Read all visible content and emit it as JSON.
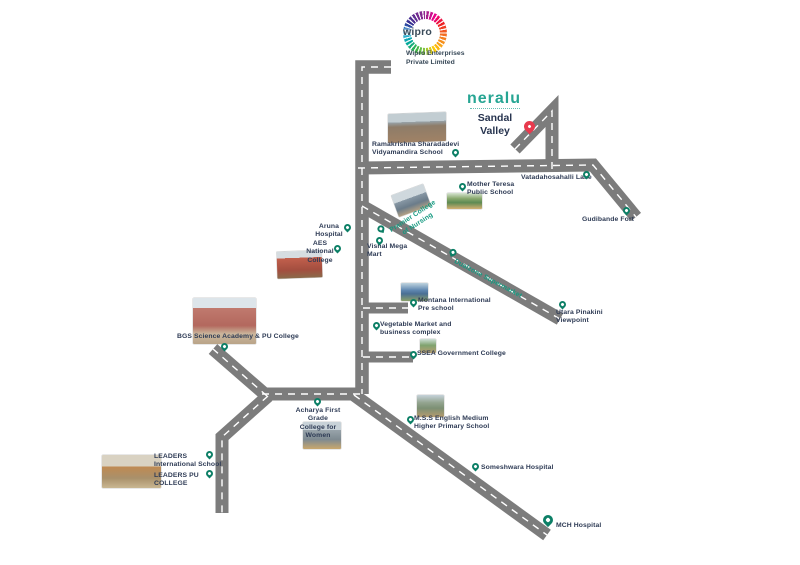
{
  "map": {
    "brands": {
      "wipro": {
        "logo_text": "wipro",
        "company": "Wipro Enterprises\nPrivate Limited"
      },
      "neralu": {
        "logo_text": "neralu",
        "project": "Sandal\nValley"
      }
    },
    "colors": {
      "road": "#7c7c7c",
      "road_dash": "#ffffff",
      "pin": "#0c7f66",
      "text": "#2e3b55",
      "teal_text": "#159a81",
      "neralu_teal": "#26a593",
      "red_pin": "#e83a4e",
      "wipro_navy": "#394a59"
    },
    "pois": [
      {
        "id": "ramakrishna-school",
        "label": "Ramakrishna Sharadadevi\nVidyamandira School"
      },
      {
        "id": "mother-teresa-school",
        "label": "Mother Teresa\nPublic School"
      },
      {
        "id": "vatadahosahalli-lake",
        "label": "Vatadahosahalli Lake"
      },
      {
        "id": "gudibande-fort",
        "label": "Gudibande Fort"
      },
      {
        "id": "aruna-hospital",
        "label": "Aruna\nHospital"
      },
      {
        "id": "aes-national-college",
        "label": "AES National\nCollege"
      },
      {
        "id": "premier-college",
        "label": "Premier College\nof Nursing"
      },
      {
        "id": "vishal-mega-mart",
        "label": "Vishal Mega\nMart"
      },
      {
        "id": "dualzone-supermarket",
        "label": "Dualzone Supermarket"
      },
      {
        "id": "montana-preschool",
        "label": "Montana International\nPre school"
      },
      {
        "id": "vegetable-market",
        "label": "Vegetable Market and\nbusiness complex"
      },
      {
        "id": "ssea-college",
        "label": "SSEA Government College"
      },
      {
        "id": "utara-viewpoint",
        "label": "Utara Pinakini\nViewpoint"
      },
      {
        "id": "bgs-academy",
        "label": "BGS Science Academy & PU College"
      },
      {
        "id": "acharya-college",
        "label": "Acharya First Grade\nCollege for Women"
      },
      {
        "id": "mss-school",
        "label": "M.S.S English Medium\nHigher Primary School"
      },
      {
        "id": "leaders-intl-school",
        "label": "LEADERS\nInternational School"
      },
      {
        "id": "leaders-pu-college",
        "label": "LEADERS PU\nCOLLEGE"
      },
      {
        "id": "someshwara-hospital",
        "label": "Someshwara Hospital"
      },
      {
        "id": "mch-hospital",
        "label": "MCH Hospital"
      }
    ]
  }
}
